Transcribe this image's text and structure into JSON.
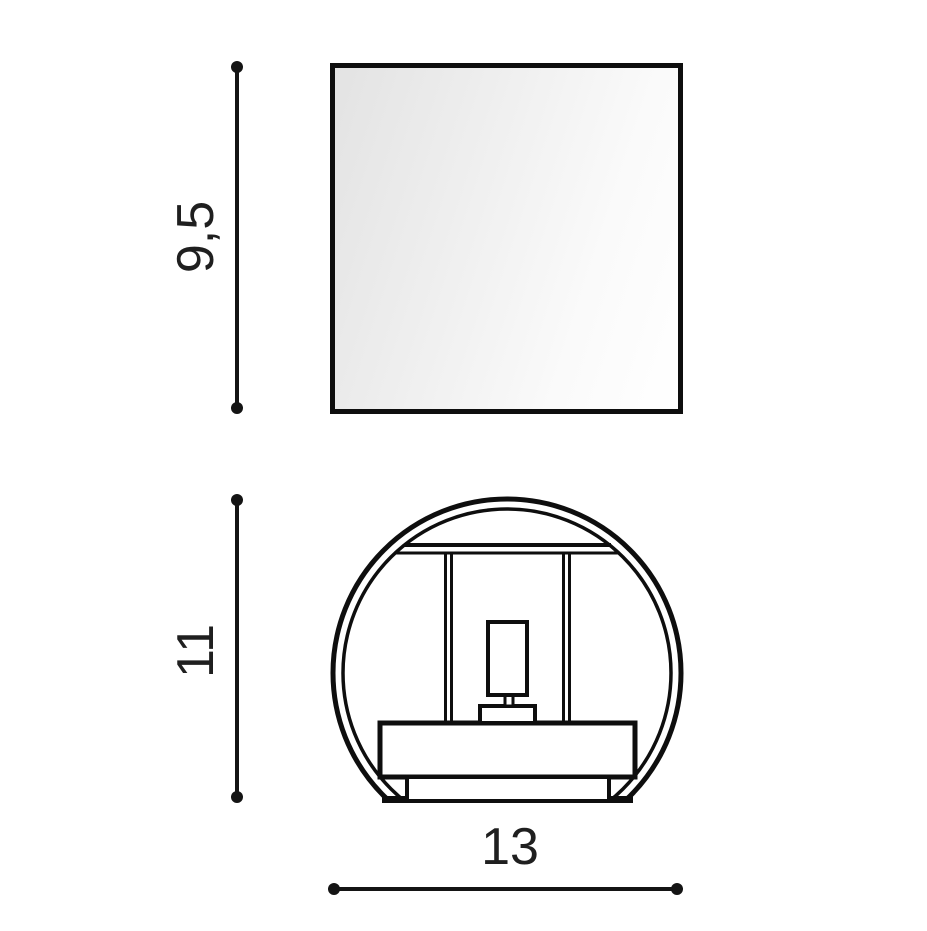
{
  "canvas": {
    "background": "#ffffff",
    "ink": "#141414"
  },
  "views": {
    "front": {
      "shape": "square",
      "height_dimension": "9,5"
    },
    "side": {
      "shape": "round",
      "height_dimension": "11",
      "width_dimension": "13"
    }
  }
}
